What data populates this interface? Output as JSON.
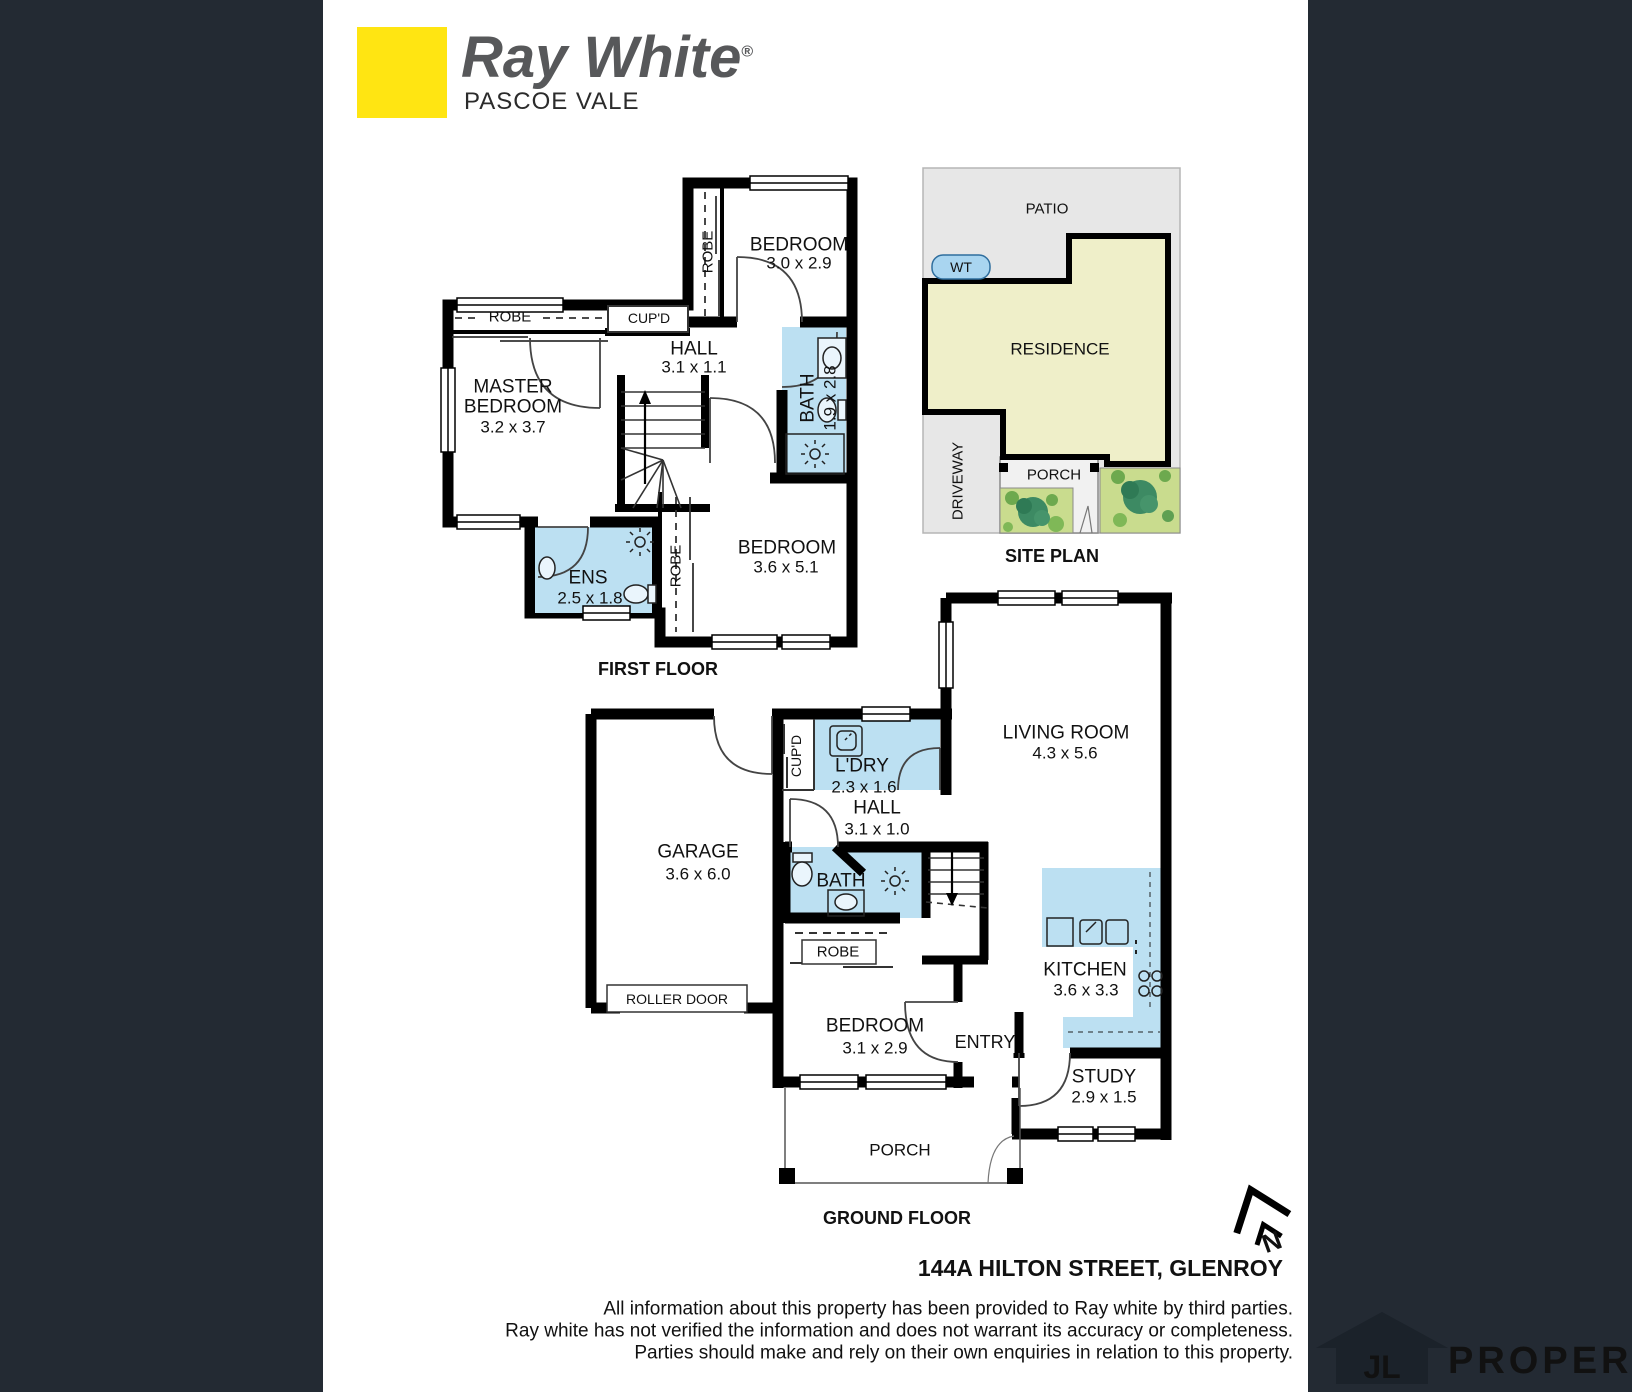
{
  "brand": {
    "name": "Ray White",
    "registered": "®",
    "office": "PASCOE VALE",
    "accent_yellow": "#FFE512"
  },
  "colors": {
    "wall": "#000000",
    "wet_area": "#BCE0F2",
    "site_gray": "#E7E7E7",
    "residence_fill": "#EFEFC9",
    "garden": "#C9DC8E",
    "dark_band": "#232A33"
  },
  "first_floor": {
    "label": "FIRST FLOOR",
    "rooms": {
      "bedroom2": {
        "name": "BEDROOM",
        "dims": "3.0 x 2.9"
      },
      "robe2": "ROBE",
      "robe_master": "ROBE",
      "cupd": "CUP'D",
      "hall": {
        "name": "HALL",
        "dims": "3.1 x 1.1"
      },
      "master": {
        "line1": "MASTER",
        "line2": "BEDROOM",
        "dims": "3.2 x 3.7"
      },
      "bath": {
        "name": "BATH",
        "dims": "1.9 x 2.8"
      },
      "ens": {
        "name": "ENS",
        "dims": "2.5 x 1.8"
      },
      "robe3": "ROBE",
      "bedroom3": {
        "name": "BEDROOM",
        "dims": "3.6 x 5.1"
      }
    }
  },
  "site_plan": {
    "label": "SITE PLAN",
    "patio": "PATIO",
    "wt": "WT",
    "residence": "RESIDENCE",
    "driveway": "DRIVEWAY",
    "porch": "PORCH"
  },
  "ground_floor": {
    "label": "GROUND FLOOR",
    "rooms": {
      "cupd": "CUP'D",
      "ldry": {
        "name": "L'DRY",
        "dims": "2.3 x 1.6"
      },
      "living": {
        "name": "LIVING ROOM",
        "dims": "4.3 x 5.6"
      },
      "hall": {
        "name": "HALL",
        "dims": "3.1 x 1.0"
      },
      "garage": {
        "name": "GARAGE",
        "dims": "3.6 x 6.0"
      },
      "roller_door": "ROLLER DOOR",
      "bath": "BATH",
      "robe": "ROBE",
      "bedroom": {
        "name": "BEDROOM",
        "dims": "3.1 x 2.9"
      },
      "entry": "ENTRY",
      "kitchen": {
        "name": "KITCHEN",
        "dims": "3.6 x 3.3"
      },
      "study": {
        "name": "STUDY",
        "dims": "2.9 x 1.5"
      },
      "porch": "PORCH"
    }
  },
  "address": "144A HILTON STREET, GLENROY",
  "disclaimer": [
    "All information about this property has been provided to Ray white by third parties.",
    "Ray white has not verified the information and does not warrant its accuracy or completeness.",
    "Parties should make and rely on their own enquiries in relation to this property."
  ],
  "compass": {
    "label": "N"
  },
  "watermark": {
    "initials": "JL",
    "text": "PROPERTY"
  }
}
